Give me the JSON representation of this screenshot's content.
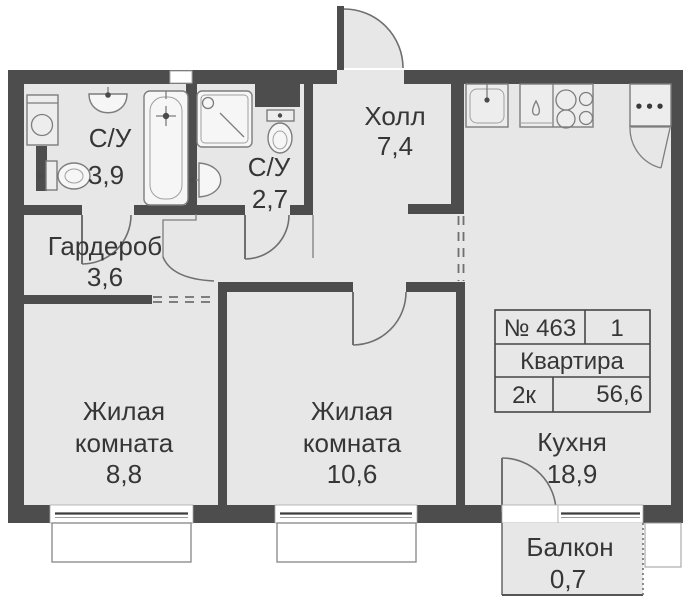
{
  "rooms": {
    "bathroom_large": {
      "name": "С/У",
      "area": "3,9"
    },
    "bathroom_small": {
      "name": "С/У",
      "area": "2,7"
    },
    "hall": {
      "name": "Холл",
      "area": "7,4"
    },
    "wardrobe": {
      "name": "Гардероб",
      "area": "3,6"
    },
    "living_room_1": {
      "name": "Жилая",
      "name2": "комната",
      "area": "8,8"
    },
    "living_room_2": {
      "name": "Жилая",
      "name2": "комната",
      "area": "10,6"
    },
    "kitchen": {
      "name": "Кухня",
      "area": "18,9"
    },
    "balcony": {
      "name": "Балкон",
      "area": "0,7"
    }
  },
  "info_table": {
    "unit_number": "№ 463",
    "entrance": "1",
    "title": "Квартира",
    "layout": "2к",
    "total_area": "56,6"
  },
  "icons": {
    "kitchen_dots": "•••"
  },
  "colors": {
    "wall": "#4d4d4d",
    "floor": "#e7e7e7",
    "accent_text": "#363636"
  }
}
